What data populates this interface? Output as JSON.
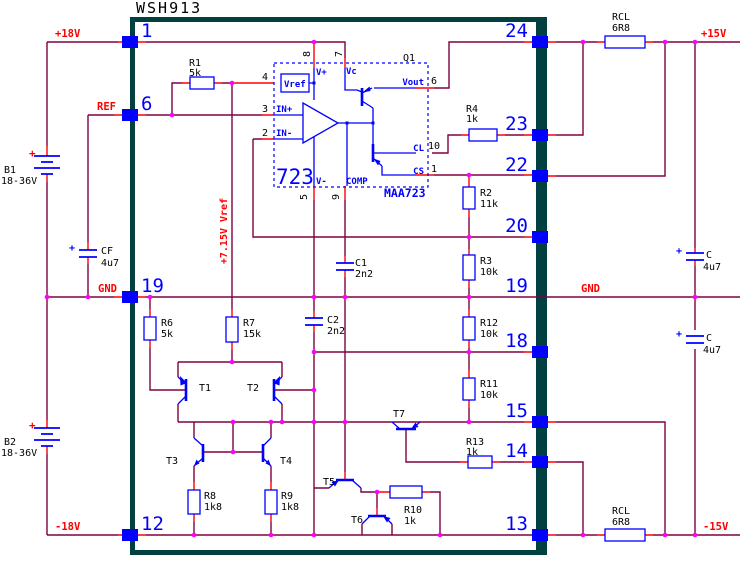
{
  "title": "WSH913",
  "colors": {
    "wire": "#800040",
    "accent": "#FF0000",
    "component": "#0000FF",
    "junction": "#FF00FF",
    "border": "#004040",
    "text": "#000000"
  },
  "power": {
    "p18": "+18V",
    "ref": "REF",
    "gnd_left": "GND",
    "m18": "-18V",
    "p15": "+15V",
    "gnd_right": "GND",
    "m15": "-15V",
    "vref_rail": "+7.15V Vref"
  },
  "pins": {
    "left": [
      "1",
      "6",
      "19",
      "12"
    ],
    "right": [
      "24",
      "23",
      "22",
      "20",
      "19",
      "18",
      "15",
      "14",
      "13"
    ]
  },
  "regulator": {
    "part": "723",
    "device": "MAA723",
    "q1": "Q1",
    "vref": "Vref",
    "vplus": "V+",
    "vc": "Vc",
    "in_plus": "IN+",
    "in_minus": "IN-",
    "vminus": "V-",
    "comp": "COMP",
    "vout": "Vout",
    "cl": "CL",
    "cs": "CS",
    "pin8": "8",
    "pin7": "7",
    "pin4": "4",
    "pin3": "3",
    "pin2": "2",
    "pin5": "5",
    "pin9": "9",
    "pin6": "6",
    "pin10": "10",
    "pin1": "1"
  },
  "components": {
    "r1": {
      "ref": "R1",
      "value": "5k"
    },
    "r2": {
      "ref": "R2",
      "value": "11k"
    },
    "r3": {
      "ref": "R3",
      "value": "10k"
    },
    "r4": {
      "ref": "R4",
      "value": "1k"
    },
    "r6": {
      "ref": "R6",
      "value": "5k"
    },
    "r7": {
      "ref": "R7",
      "value": "15k"
    },
    "r8": {
      "ref": "R8",
      "value": "1k8"
    },
    "r9": {
      "ref": "R9",
      "value": "1k8"
    },
    "r10": {
      "ref": "R10",
      "value": "1k"
    },
    "r11": {
      "ref": "R11",
      "value": "10k"
    },
    "r12": {
      "ref": "R12",
      "value": "10k"
    },
    "r13": {
      "ref": "R13",
      "value": "1k"
    },
    "rcl_top": {
      "ref": "RCL",
      "value": "6R8"
    },
    "rcl_bottom": {
      "ref": "RCL",
      "value": "6R8"
    },
    "c1": {
      "ref": "C1",
      "value": "2n2"
    },
    "c2": {
      "ref": "C2",
      "value": "2n2"
    },
    "cf": {
      "ref": "CF",
      "value": "4u7"
    },
    "c_top": {
      "ref": "C",
      "value": "4u7"
    },
    "c_bottom": {
      "ref": "C",
      "value": "4u7"
    },
    "b1": {
      "ref": "B1",
      "value": "18-36V"
    },
    "b2": {
      "ref": "B2",
      "value": "18-36V"
    },
    "t1": "T1",
    "t2": "T2",
    "t3": "T3",
    "t4": "T4",
    "t5": "T5",
    "t6": "T6",
    "t7": "T7",
    "plus": "+"
  }
}
